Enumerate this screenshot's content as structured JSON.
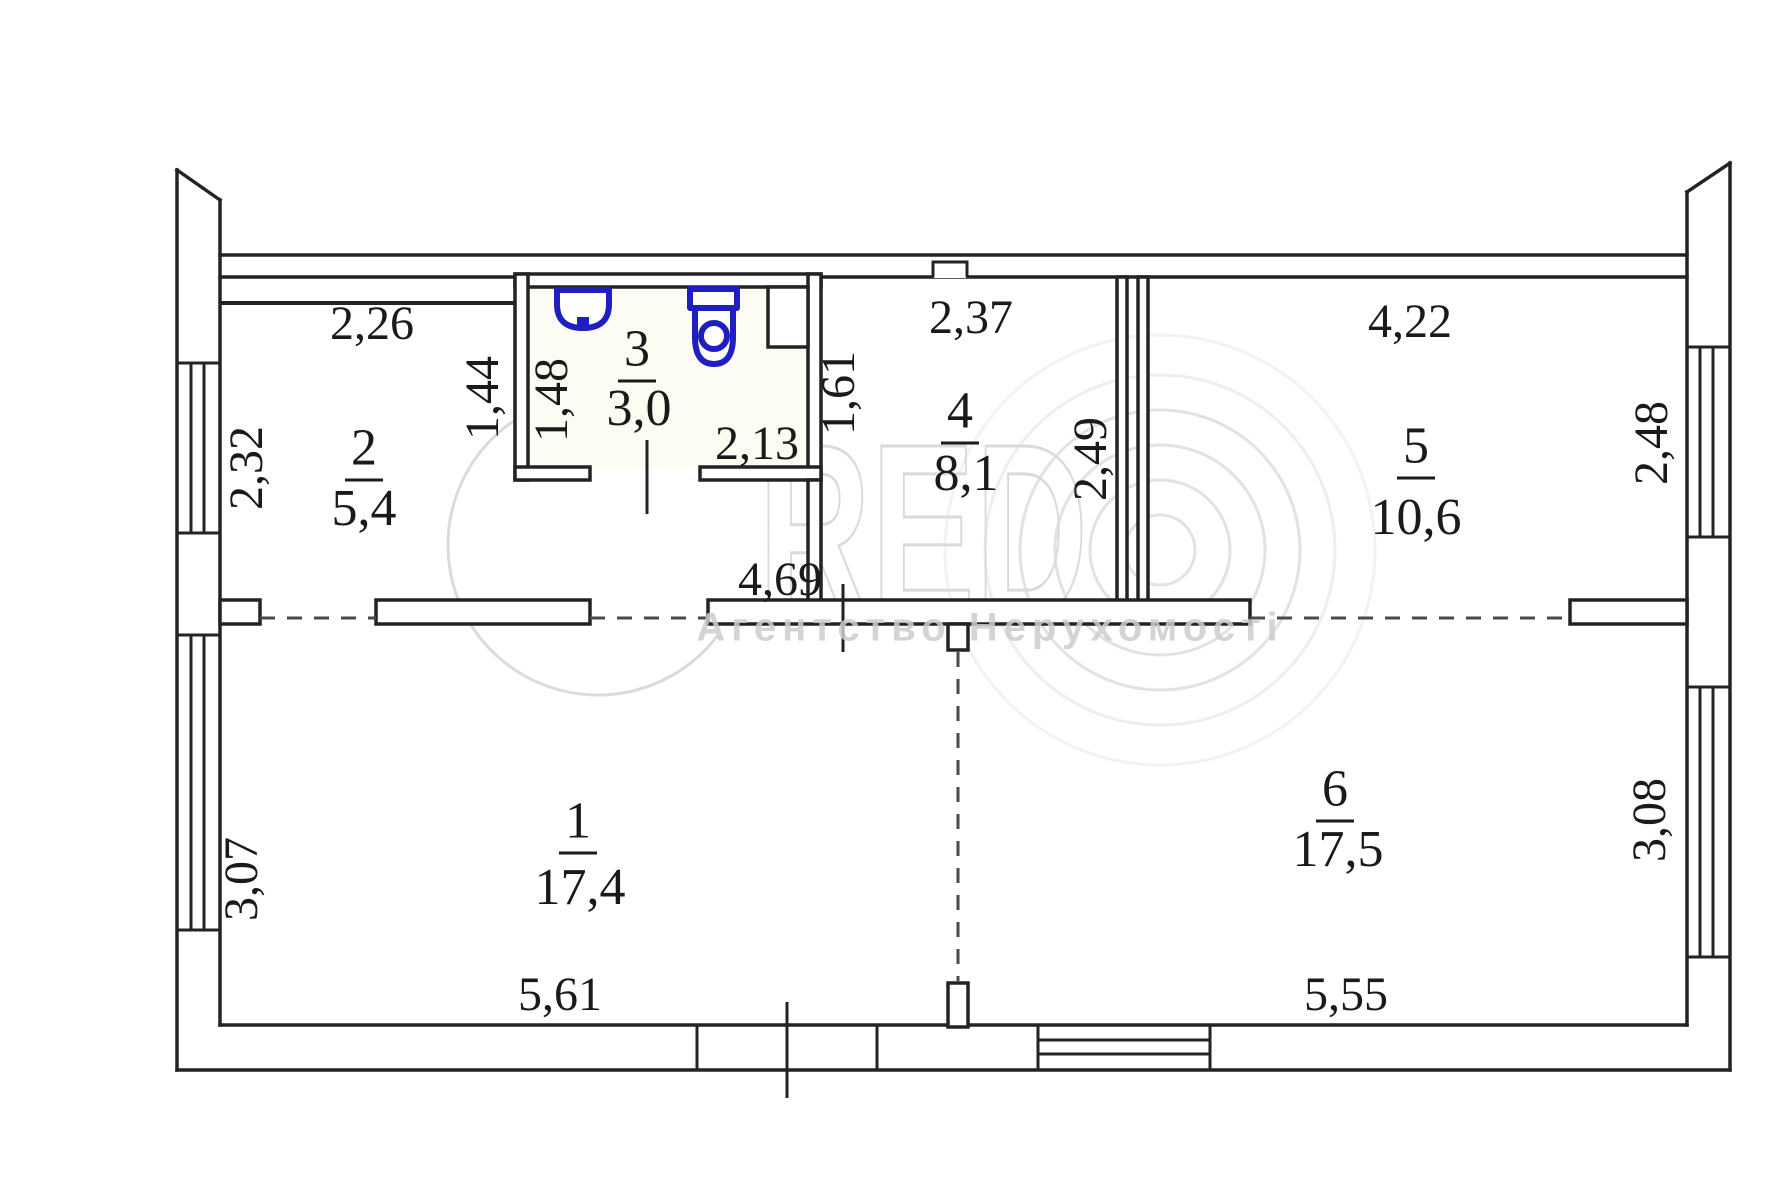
{
  "title": "apartment-floor-plan",
  "colors": {
    "line": "#232323",
    "fixture_blue": "#1f1fbf",
    "text": "#1a1a1a",
    "watermark_gray": "#c7c7c7"
  },
  "rooms": [
    {
      "number": "1",
      "area": "17,4"
    },
    {
      "number": "2",
      "area": "5,4"
    },
    {
      "number": "3",
      "area": "3,0"
    },
    {
      "number": "4",
      "area": "8,1"
    },
    {
      "number": "5",
      "area": "10,6"
    },
    {
      "number": "6",
      "area": "17,5"
    }
  ],
  "dimensions": {
    "room2_width": "2,26",
    "room2_window": "2,32",
    "bath_outer_left": "1,44",
    "bath_inner_left": "1,48",
    "bath_width": "2,13",
    "bath_right": "1,61",
    "room4_width": "2,37",
    "room4_right": "2,49",
    "room5_width": "4,22",
    "room5_window": "2,48",
    "hall_width": "4,69",
    "room1_window": "3,07",
    "room1_width": "5,61",
    "room6_window": "3,08",
    "room6_width": "5,55"
  },
  "fixtures": [
    "sink-icon",
    "toilet-icon"
  ],
  "watermark": {
    "red": "RED",
    "agency": "Агентство Нерухомості"
  }
}
